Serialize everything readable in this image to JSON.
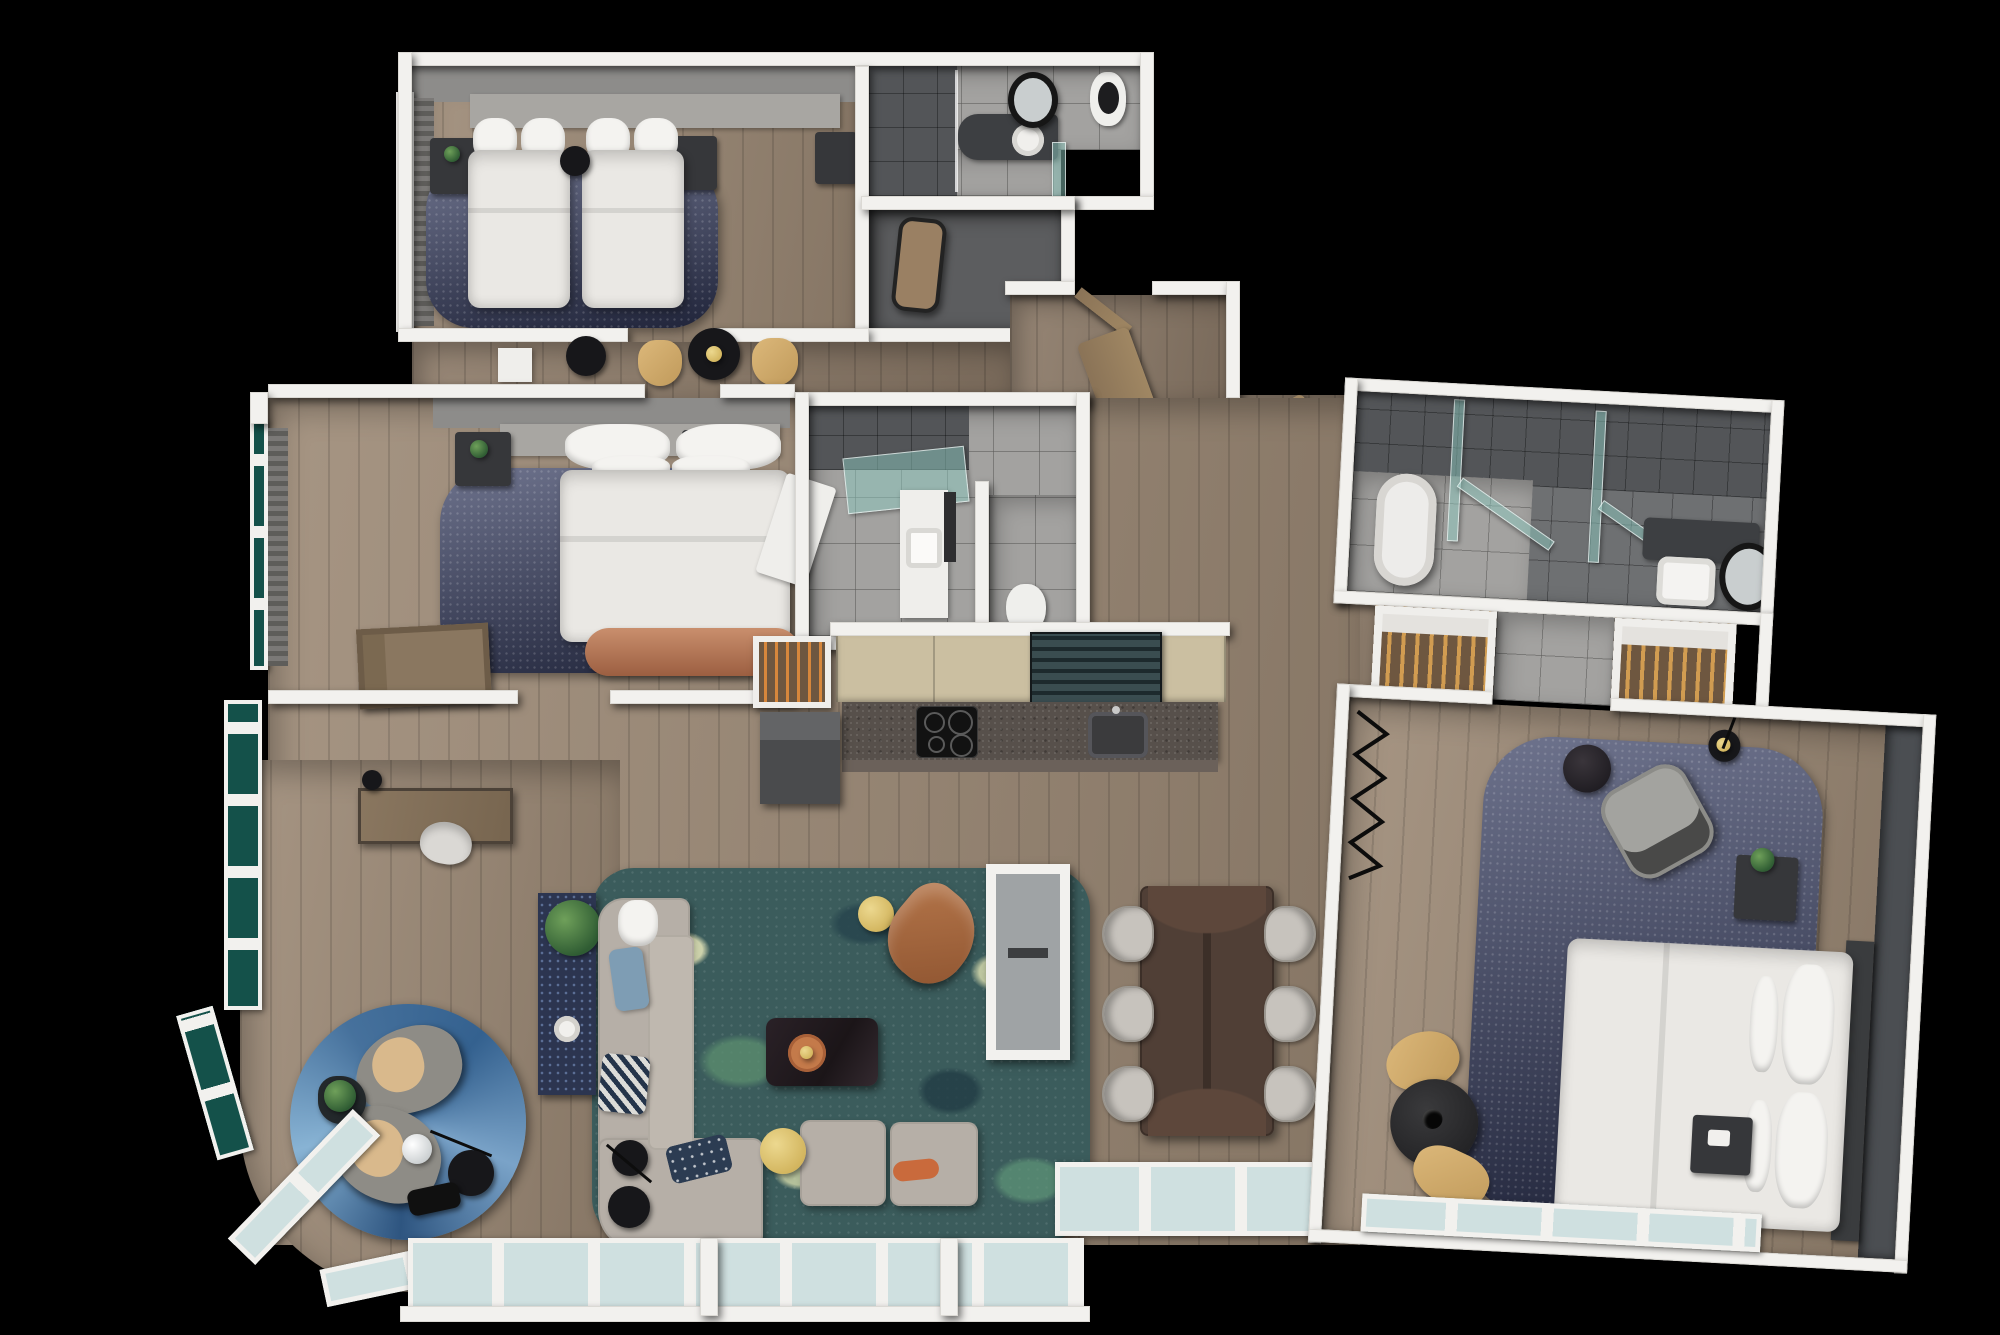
{
  "scene": {
    "kind": "3d-floor-plan-render",
    "view": "top-down bird's-eye 3D render of a three-bedroom apartment floating on a black background",
    "visible_text": "none",
    "background_color": "#000000"
  },
  "palette": {
    "background": "#000000",
    "outer_walls": "#f2f1ee",
    "partition_walls": "#90908e",
    "wood_floor": "#9c8975",
    "tile_floor": "#a3a2a0",
    "dark_tile": "#6e7072",
    "shower_tile": "#535558",
    "bedroom_rug_navy": "#353c60",
    "living_rug_teal": "#3b5c5c",
    "nook_rug_blue": "#4f7fae",
    "bedding_white": "#eae8e4",
    "sofa_gray": "#b6afa7",
    "leather_brown": "#a8643c",
    "brass_gold": "#d9bf6e",
    "kitchen_cabinet_tan": "#cbbfa1",
    "kitchen_counter_granite": "#57504b",
    "louvered_cabinet_teal": "#2c3a3d",
    "window_glass_teal": "#14514a",
    "window_glass_pale": "#cfe0e0",
    "accent_wall_gray": "#8d8c8a",
    "copper_bench": "#b4765a"
  },
  "rooms": [
    {
      "name": "twin-bedroom",
      "furniture": [
        "twin-bed",
        "twin-bed",
        "pillows",
        "nightstand-with-plant",
        "nightstand",
        "round-side-table",
        "luggage-bench",
        "navy-area-rug",
        "headboard-accent-wall",
        "curtains",
        "teal-windows"
      ]
    },
    {
      "name": "twin-ensuite-bathroom",
      "furniture": [
        "walk-in-shower",
        "glass-screen",
        "vanity-counter",
        "round-basin",
        "round-mirror",
        "toilet"
      ]
    },
    {
      "name": "dressing-vestibule",
      "furniture": [
        "leaning-mirror"
      ]
    },
    {
      "name": "lounge-corridor",
      "furniture": [
        "side-table-white",
        "round-black-table",
        "tan-chair",
        "round-black-table-with-candle",
        "tan-chair"
      ]
    },
    {
      "name": "queen-bedroom",
      "furniture": [
        "queen-bed",
        "pillows",
        "nightstand-with-plant",
        "nightstand",
        "copper-bench",
        "navy-area-rug",
        "open-wardrobe",
        "headboard-accent-wall",
        "curtains",
        "teal-windows",
        "desk",
        "desk-lamp",
        "white-chair"
      ]
    },
    {
      "name": "family-bathroom",
      "furniture": [
        "walk-in-shower",
        "teal-glass-screen",
        "vanity-basin",
        "mirror-panel",
        "open-door"
      ]
    },
    {
      "name": "wc",
      "furniture": [
        "toilet"
      ]
    },
    {
      "name": "entry-hall",
      "furniture": [
        "entry-door",
        "open-wood-door",
        "open-wood-door",
        "gray-store-walls",
        "zigzag-wall-art"
      ]
    },
    {
      "name": "kitchen",
      "furniture": [
        "upper-cabinets",
        "louvered-cabinets",
        "granite-counter",
        "induction-cooktop",
        "kitchen-sink",
        "tall-appliance-unit",
        "open-wardrobe-with-hangers"
      ]
    },
    {
      "name": "living-room",
      "furniture": [
        "sectional-sofa",
        "chaise-modules",
        "blue-cushion",
        "houndstooth-cushion",
        "navy-cushion",
        "orange-cushion",
        "marble-coffee-table",
        "orange-tray",
        "gold-side-table",
        "gold-side-table",
        "leather-armchair",
        "floor-lamp",
        "black-side-table",
        "console-table",
        "plant",
        "white-vase",
        "teal-mottled-rug",
        "double-sided-fireplace"
      ]
    },
    {
      "name": "dining-room",
      "furniture": [
        "dark-wood-dining-table",
        "dining-chair",
        "dining-chair",
        "dining-chair",
        "dining-chair",
        "dining-chair",
        "dining-chair",
        "window-wall"
      ]
    },
    {
      "name": "window-nook",
      "furniture": [
        "round-blue-rug",
        "lounge-chair",
        "lounge-chair",
        "black-plant-table",
        "globe-lamp",
        "black-shade-lamp",
        "black-side-table",
        "wraparound-windows"
      ]
    },
    {
      "name": "master-bathroom",
      "furniture": [
        "freestanding-bathtub",
        "teal-glass-shower-screens",
        "vanity-counter",
        "basin",
        "round-mirror"
      ]
    },
    {
      "name": "walk-in-closet-left",
      "furniture": [
        "hanging-clothes",
        "white-shelf"
      ]
    },
    {
      "name": "walk-in-closet-right",
      "furniture": [
        "hanging-clothes",
        "white-shelf"
      ]
    },
    {
      "name": "master-bedroom",
      "furniture": [
        "king-bed",
        "pillows",
        "headboard",
        "dark-accent-wall",
        "navy-area-rug",
        "armchair",
        "marble-side-table",
        "floor-lamp",
        "nightstand-with-plant",
        "nightstand",
        "tan-chair",
        "tan-chair",
        "round-black-table-with-vase",
        "zigzag-wall-art",
        "window-wall"
      ]
    }
  ]
}
